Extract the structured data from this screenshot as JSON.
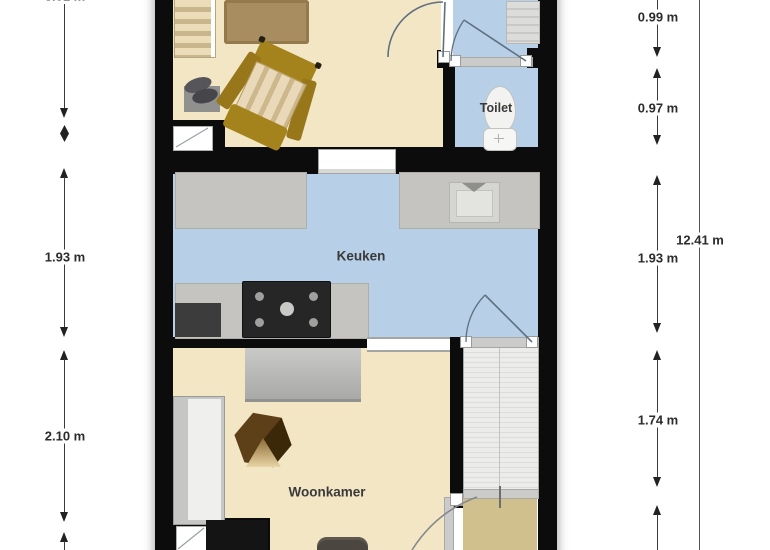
{
  "plan": {
    "rooms": {
      "toilet": "Toilet",
      "kitchen": "Keuken",
      "living_room": "Woonkamer"
    }
  },
  "dimensions": {
    "left": [
      "3.01 m",
      "1.93 m",
      "2.10 m"
    ],
    "right": [
      "0.99 m",
      "0.97 m",
      "1.93 m",
      "1.74 m"
    ],
    "total_height": "12.41 m"
  },
  "colors": {
    "floor_cream": "#f3e6c4",
    "floor_blue": "#b7cfe7",
    "floor_hall": "#cfc08d",
    "wall": "#0c0c0c",
    "counter_gray": "#c5c4c1",
    "wood_accent": "#a5831c",
    "dimension_text": "#2b2b2b"
  }
}
